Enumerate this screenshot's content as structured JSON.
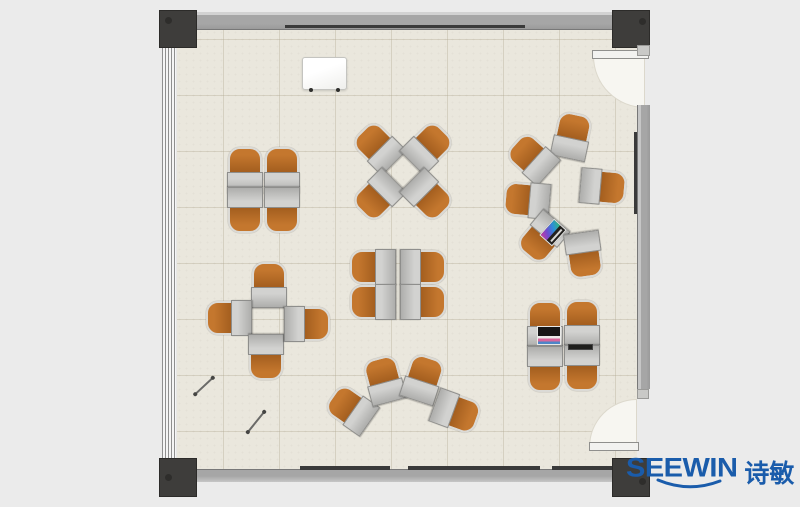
{
  "scene": {
    "description": "Classroom training-room furniture floor plan, top view, with desk-chair units arranged in clusters",
    "colors": {
      "bg": "#ebebeb",
      "floor": "#eae7dd",
      "wall": "#9a9a9a",
      "wall-dark": "#787878",
      "post": "#3e3d3b",
      "rail": "#3a3a3a",
      "door": "#f7f6f1",
      "chair": "#c4772e",
      "chair-dark": "#a25d1e",
      "chair-trim": "#dbdad6",
      "desk": "#d2d2d0",
      "desk-dark": "#aeaeac",
      "desk-edge": "#8e8e8c",
      "blue": "#1a5cab"
    }
  },
  "logo": {
    "brand": "SEEWIN",
    "brand_cn": "诗敏",
    "color": "#1a5cab"
  },
  "furniture": {
    "clusters": [
      {
        "name": "quad-facing-vertical-top-left",
        "units": [
          [
            245,
            170,
            0
          ],
          [
            282,
            170,
            0
          ],
          [
            245,
            210,
            180
          ],
          [
            282,
            210,
            180
          ]
        ]
      },
      {
        "name": "quad-rotated-45-top-center",
        "units": [
          [
            378,
            147,
            -45
          ],
          [
            428,
            147,
            45
          ],
          [
            378,
            196,
            -135
          ],
          [
            428,
            196,
            135
          ]
        ]
      },
      {
        "name": "circle-of-six-right",
        "units": [
          [
            572,
            136,
            12
          ],
          [
            532,
            158,
            -48
          ],
          [
            527,
            200,
            -85
          ],
          [
            603,
            187,
            95
          ],
          [
            542,
            238,
            -140
          ],
          [
            584,
            255,
            172
          ]
        ]
      },
      {
        "name": "cross-pinwheel-middle-left",
        "units": [
          [
            269,
            285,
            0
          ],
          [
            229,
            318,
            -90
          ],
          [
            266,
            357,
            180
          ],
          [
            307,
            324,
            90
          ]
        ]
      },
      {
        "name": "quad-facing-horizontal-center",
        "units": [
          [
            373,
            267,
            -90
          ],
          [
            423,
            267,
            90
          ],
          [
            373,
            302,
            -90
          ],
          [
            423,
            302,
            90
          ]
        ]
      },
      {
        "name": "fan-arc-bottom-center",
        "units": [
          [
            351,
            409,
            -55
          ],
          [
            384,
            380,
            -15
          ],
          [
            423,
            379,
            18
          ],
          [
            456,
            412,
            110
          ]
        ]
      },
      {
        "name": "quad-facing-vertical-bottom-right",
        "units": [
          [
            545,
            324,
            0
          ],
          [
            582,
            323,
            0
          ],
          [
            545,
            369,
            180
          ],
          [
            582,
            368,
            180
          ]
        ]
      }
    ],
    "props": {
      "whiteboard": {
        "x": 302,
        "y": 57,
        "w": 43,
        "h": 31
      },
      "laptops": [
        {
          "x": 553,
          "y": 232,
          "w": 22,
          "h": 17,
          "r": -48,
          "style": "rainbow-screen"
        },
        {
          "x": 549,
          "y": 335,
          "w": 24,
          "h": 19,
          "r": 0,
          "style": "dark-screen"
        }
      ],
      "tablet": {
        "x": 580,
        "y": 347,
        "w": 25,
        "h": 6
      },
      "pens": [
        {
          "x": 204,
          "y": 386,
          "len": 24,
          "r": -43
        },
        {
          "x": 256,
          "y": 422,
          "len": 26,
          "r": -51
        }
      ]
    }
  }
}
